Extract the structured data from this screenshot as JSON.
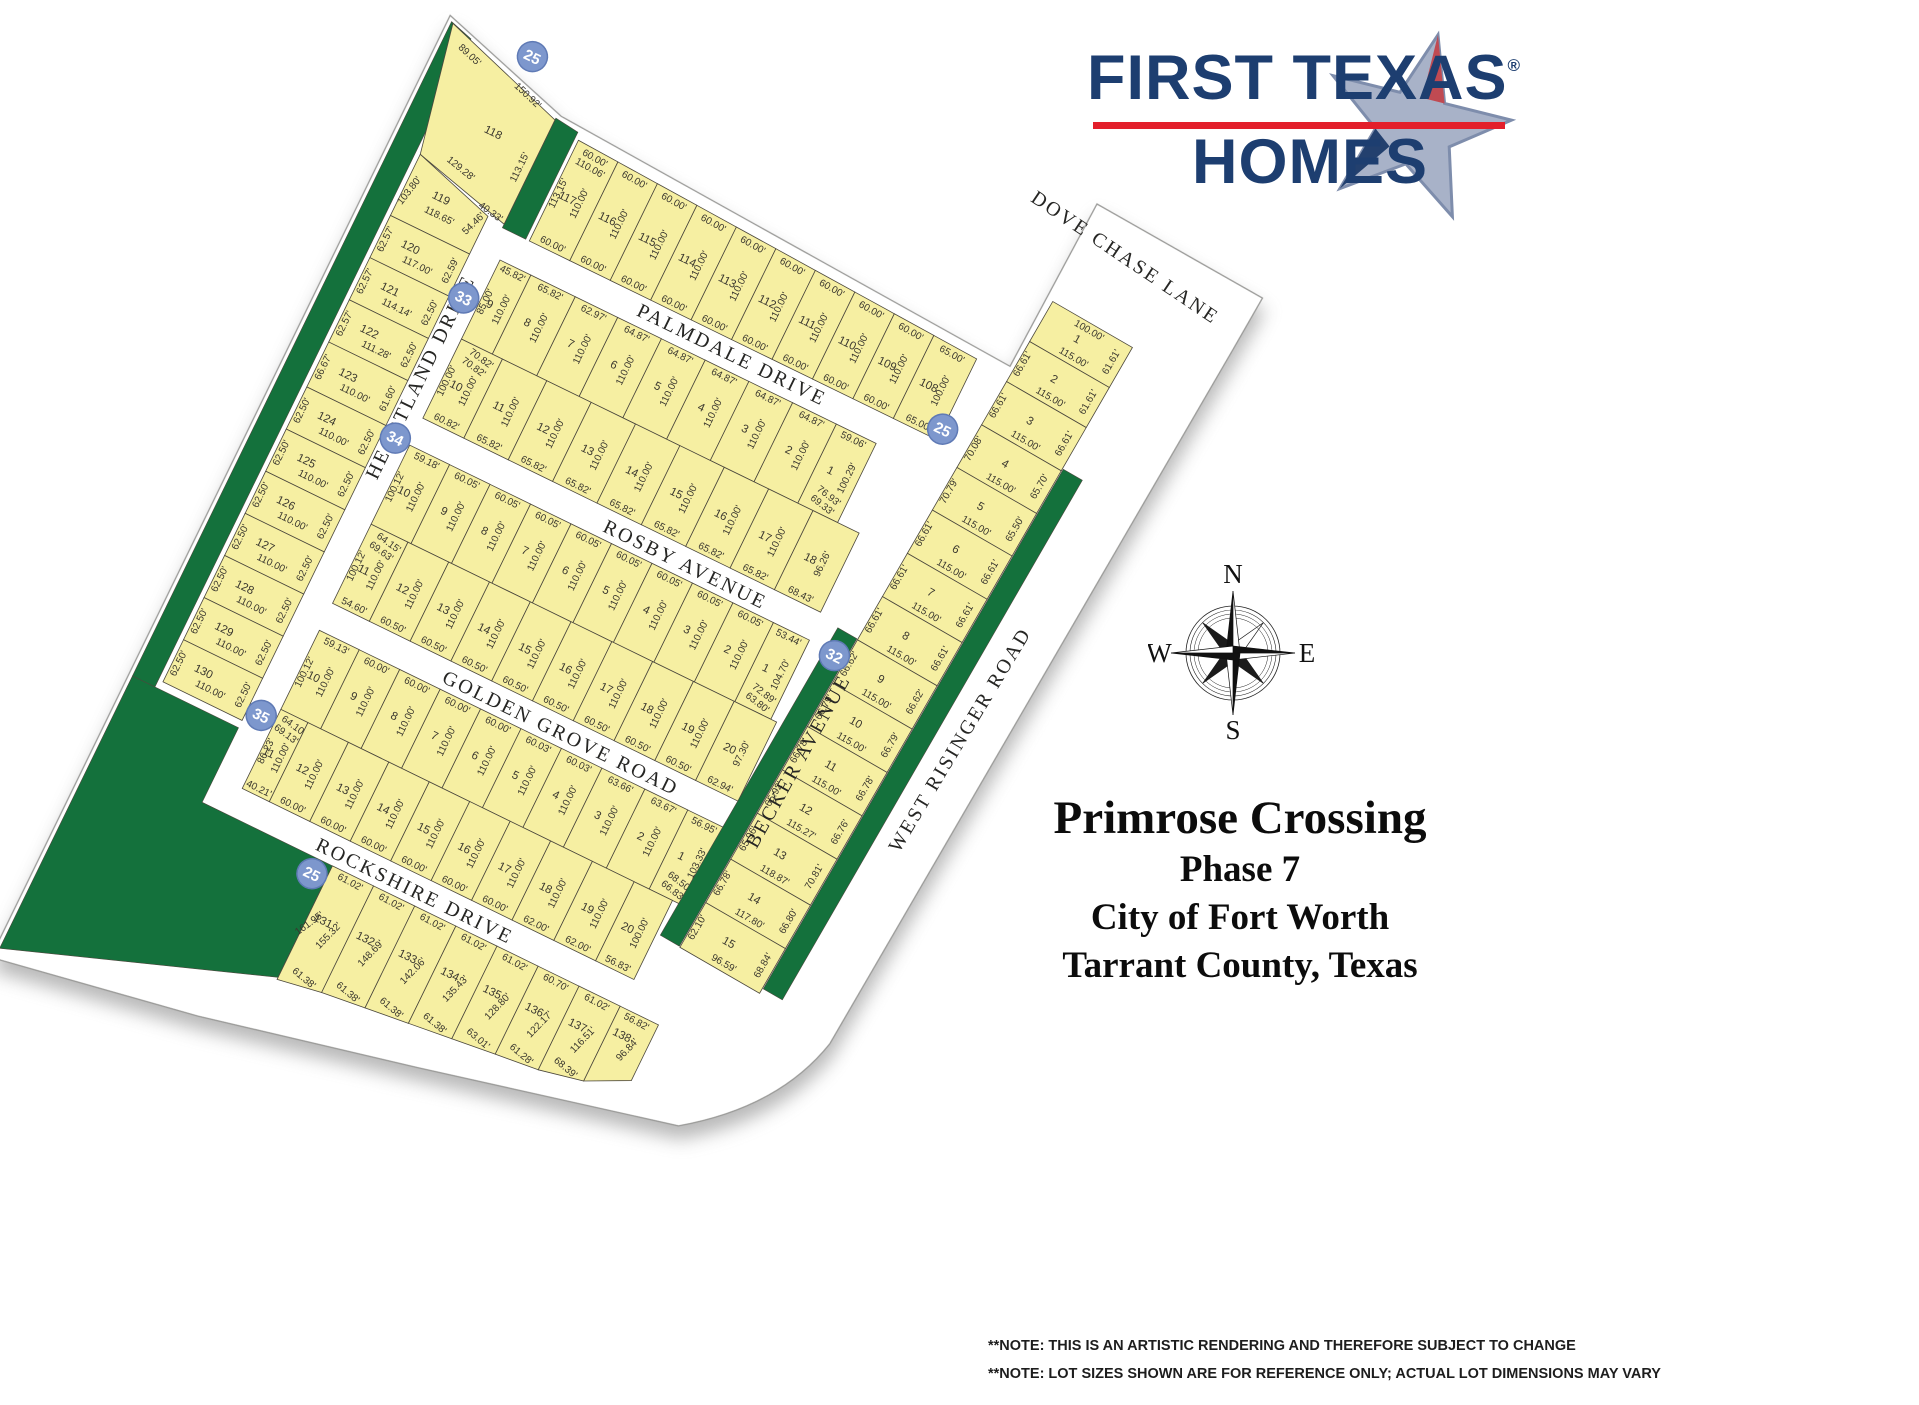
{
  "logo": {
    "line1": "FIRST TEXAS",
    "reg": "®",
    "line2": "HOMES"
  },
  "title": {
    "line1": "Primrose Crossing",
    "line2": "Phase 7",
    "line3": "City of Fort Worth",
    "line4": "Tarrant County, Texas"
  },
  "notes": [
    "**NOTE: THIS IS AN ARTISTIC RENDERING AND THEREFORE SUBJECT TO CHANGE",
    "**NOTE: LOT SIZES SHOWN ARE FOR REFERENCE ONLY; ACTUAL LOT DIMENSIONS MAY VARY"
  ],
  "compass": {
    "n": "N",
    "e": "E",
    "s": "S",
    "w": "W"
  },
  "map": {
    "colors": {
      "lot": "#f6efa2",
      "lot_border": "#4b473c",
      "green": "#14713c",
      "circle": "#7d97cd",
      "circle_border": "#5f7ab5",
      "street_text": "#262624",
      "dim_text": "#3a372e",
      "boundary": "#9a9a98"
    },
    "streets": [
      "PALMDALE DRIVE",
      "ROSBY AVENUE",
      "GOLDEN GROVE ROAD",
      "ROCKSHIRE DRIVE",
      "HEARTLAND DRIVE",
      "BECKER AVENUE",
      "WEST RISINGER ROAD",
      "DOVE CHASE LANE"
    ],
    "circles": [
      "25",
      "25",
      "33",
      "34",
      "35",
      "32",
      "25"
    ],
    "blocks": {
      "north_row": [
        {
          "n": "117",
          "w": "60.00'",
          "d": "110.00'",
          "e": [
            "113.15'",
            "110.06'"
          ]
        },
        {
          "n": "116",
          "w": "60.00'",
          "d": "110.00'"
        },
        {
          "n": "115",
          "w": "60.00'",
          "d": "110.00'"
        },
        {
          "n": "114",
          "w": "60.00'",
          "d": "110.00'"
        },
        {
          "n": "113",
          "w": "60.00'",
          "d": "110.00'"
        },
        {
          "n": "112",
          "w": "60.00'",
          "d": "110.00'"
        },
        {
          "n": "111",
          "w": "60.00'",
          "d": "110.00'"
        },
        {
          "n": "110",
          "w": "60.00'",
          "d": "110.00'"
        },
        {
          "n": "109",
          "w": "60.00'",
          "d": "110.00'"
        },
        {
          "n": "108",
          "w": "65.00'",
          "d": "100.00'"
        }
      ],
      "lot118": {
        "n": "118",
        "e": [
          "89.05'",
          "150.92'",
          "129.28'",
          "113.15'",
          "40.33'"
        ]
      },
      "west_column": [
        {
          "n": "119",
          "w": "103.80'",
          "d": "118.65'",
          "e": [
            "54.46'"
          ]
        },
        {
          "n": "120",
          "w": "62.57'",
          "d": "117.00'",
          "e": [
            "62.59'"
          ]
        },
        {
          "n": "121",
          "w": "62.57'",
          "d": "114.14'",
          "e": [
            "62.50'"
          ]
        },
        {
          "n": "122",
          "w": "62.57'",
          "d": "111.28'",
          "e": [
            "62.50'"
          ]
        },
        {
          "n": "123",
          "w": "66.67'",
          "d": "110.00'",
          "e": [
            "61.60'"
          ]
        },
        {
          "n": "124",
          "w": "62.50'",
          "d": "110.00'",
          "e": [
            "62.50'"
          ]
        },
        {
          "n": "125",
          "w": "62.50'",
          "d": "110.00'",
          "e": [
            "62.50'"
          ]
        },
        {
          "n": "126",
          "w": "62.50'",
          "d": "110.00'",
          "e": [
            "62.50'"
          ]
        },
        {
          "n": "127",
          "w": "62.50'",
          "d": "110.00'",
          "e": [
            "62.50'"
          ]
        },
        {
          "n": "128",
          "w": "62.50'",
          "d": "110.00'",
          "e": [
            "62.50'"
          ]
        },
        {
          "n": "129",
          "w": "62.50'",
          "d": "110.00'",
          "e": [
            "62.50'"
          ]
        },
        {
          "n": "130",
          "w": "62.50'",
          "d": "110.00'",
          "e": [
            "62.50'"
          ]
        }
      ],
      "block33_north": [
        {
          "n": "9",
          "w": "45.82'",
          "d": "110.00'",
          "e": [
            "85.00'"
          ]
        },
        {
          "n": "8",
          "w": "65.82'",
          "d": "110.00'"
        },
        {
          "n": "7",
          "w": "62.97'",
          "d": "110.00'"
        },
        {
          "n": "6",
          "w": "64.87'",
          "d": "110.00'"
        },
        {
          "n": "5",
          "w": "64.87'",
          "d": "110.00'"
        },
        {
          "n": "4",
          "w": "64.87'",
          "d": "110.00'"
        },
        {
          "n": "3",
          "w": "64.87'",
          "d": "110.00'"
        },
        {
          "n": "2",
          "w": "64.87'",
          "d": "110.00'"
        },
        {
          "n": "1",
          "w": "59.06'",
          "d": "100.29'",
          "e": [
            "76.93'",
            "69.33'"
          ]
        }
      ],
      "block33_south": [
        {
          "n": "10",
          "w": "60.82'",
          "d": "110.00'",
          "e": [
            "100.00'",
            "70.82'",
            "70.82'"
          ]
        },
        {
          "n": "11",
          "w": "65.82'",
          "d": "110.00'"
        },
        {
          "n": "12",
          "w": "65.82'",
          "d": "110.00'"
        },
        {
          "n": "13",
          "w": "65.82'",
          "d": "110.00'"
        },
        {
          "n": "14",
          "w": "65.82'",
          "d": "110.00'"
        },
        {
          "n": "15",
          "w": "65.82'",
          "d": "110.00'"
        },
        {
          "n": "16",
          "w": "65.82'",
          "d": "110.00'"
        },
        {
          "n": "17",
          "w": "65.82'",
          "d": "110.00'"
        },
        {
          "n": "18",
          "w": "68.43'",
          "d": "96.26'"
        }
      ],
      "block34_north": [
        {
          "n": "10",
          "w": "59.18'",
          "d": "110.00'",
          "e": [
            "100.12'"
          ]
        },
        {
          "n": "9",
          "w": "60.05'",
          "d": "110.00'"
        },
        {
          "n": "8",
          "w": "60.05'",
          "d": "110.00'"
        },
        {
          "n": "7",
          "w": "60.05'",
          "d": "110.00'"
        },
        {
          "n": "6",
          "w": "60.05'",
          "d": "110.00'"
        },
        {
          "n": "5",
          "w": "60.05'",
          "d": "110.00'"
        },
        {
          "n": "4",
          "w": "60.05'",
          "d": "110.00'"
        },
        {
          "n": "3",
          "w": "60.05'",
          "d": "110.00'"
        },
        {
          "n": "2",
          "w": "60.05'",
          "d": "110.00'"
        },
        {
          "n": "1",
          "w": "53.44'",
          "d": "104.70'",
          "e": [
            "72.89'",
            "63.80'"
          ]
        }
      ],
      "block34_south": [
        {
          "n": "11",
          "w": "54.60'",
          "d": "110.00'",
          "e": [
            "100.12'",
            "64.15'",
            "69.63'"
          ]
        },
        {
          "n": "12",
          "w": "60.50'",
          "d": "110.00'"
        },
        {
          "n": "13",
          "w": "60.50'",
          "d": "110.00'"
        },
        {
          "n": "14",
          "w": "60.50'",
          "d": "110.00'"
        },
        {
          "n": "15",
          "w": "60.50'",
          "d": "110.00'"
        },
        {
          "n": "16",
          "w": "60.50'",
          "d": "110.00'"
        },
        {
          "n": "17",
          "w": "60.50'",
          "d": "110.00'"
        },
        {
          "n": "18",
          "w": "60.50'",
          "d": "110.00'"
        },
        {
          "n": "19",
          "w": "60.50'",
          "d": "110.00'"
        },
        {
          "n": "20",
          "w": "62.94'",
          "d": "97.30'"
        }
      ],
      "block35_north": [
        {
          "n": "10",
          "w": "59.13'",
          "d": "110.00'",
          "e": [
            "100.12'"
          ]
        },
        {
          "n": "9",
          "w": "60.00'",
          "d": "110.00'"
        },
        {
          "n": "8",
          "w": "60.00'",
          "d": "110.00'"
        },
        {
          "n": "7",
          "w": "60.00'",
          "d": "110.00'"
        },
        {
          "n": "6",
          "w": "60.00'",
          "d": "110.00'"
        },
        {
          "n": "5",
          "w": "60.03'",
          "d": "110.00'"
        },
        {
          "n": "4",
          "w": "60.03'",
          "d": "110.00'"
        },
        {
          "n": "3",
          "w": "63.66'",
          "d": "110.00'"
        },
        {
          "n": "2",
          "w": "63.67'",
          "d": "110.00'"
        },
        {
          "n": "1",
          "w": "56.95'",
          "d": "103.33'",
          "e": [
            "68.50'",
            "66.83'"
          ]
        }
      ],
      "block35_south": [
        {
          "n": "11",
          "w": "40.21'",
          "d": "110.00'",
          "e": [
            "86.23'",
            "64.10'",
            "69.13'"
          ]
        },
        {
          "n": "12",
          "w": "60.00'",
          "d": "110.00'"
        },
        {
          "n": "13",
          "w": "60.00'",
          "d": "110.00'"
        },
        {
          "n": "14",
          "w": "60.00'",
          "d": "110.00'"
        },
        {
          "n": "15",
          "w": "60.00'",
          "d": "110.00'"
        },
        {
          "n": "16",
          "w": "60.00'",
          "d": "110.00'"
        },
        {
          "n": "17",
          "w": "60.00'",
          "d": "110.00'"
        },
        {
          "n": "18",
          "w": "62.00'",
          "d": "110.00'"
        },
        {
          "n": "19",
          "w": "62.00'",
          "d": "110.00'"
        },
        {
          "n": "20",
          "w": "56.83'",
          "d": "100.00'"
        }
      ],
      "south_row": [
        {
          "n": "131",
          "w": "61.02'",
          "d": "155.32'",
          "e": [
            "161.95'",
            "61.38'"
          ]
        },
        {
          "n": "132",
          "w": "61.02'",
          "d": "148.69'",
          "e": [
            "61.38'"
          ]
        },
        {
          "n": "133",
          "w": "61.02'",
          "d": "142.06'",
          "e": [
            "61.38'"
          ]
        },
        {
          "n": "134",
          "w": "61.02'",
          "d": "135.43'",
          "e": [
            "61.38'"
          ]
        },
        {
          "n": "135",
          "w": "61.02'",
          "d": "128.80'",
          "e": [
            "63.01'"
          ]
        },
        {
          "n": "136",
          "w": "60.70'",
          "d": "122.17'",
          "e": [
            "61.28'"
          ]
        },
        {
          "n": "137",
          "w": "61.02'",
          "d": "116.51'",
          "e": [
            "68.39'"
          ]
        },
        {
          "n": "138",
          "w": "56.82'",
          "d": "96.84'"
        }
      ],
      "block32": [
        {
          "n": "1",
          "w": "61.61'",
          "d": "115.00'",
          "e": [
            "100.00'"
          ]
        },
        {
          "n": "2",
          "w": "61.61'",
          "d": "115.00'",
          "e": [
            "66.61'"
          ]
        },
        {
          "n": "3",
          "w": "66.61'",
          "d": "115.00'",
          "e": [
            "66.61'"
          ]
        },
        {
          "n": "4",
          "w": "65.70'",
          "d": "115.00'",
          "e": [
            "70.08'"
          ]
        },
        {
          "n": "5",
          "w": "65.50'",
          "d": "115.00'",
          "e": [
            "70.79'"
          ]
        },
        {
          "n": "6",
          "w": "66.61'",
          "d": "115.00'",
          "e": [
            "66.61'"
          ]
        },
        {
          "n": "7",
          "w": "66.61'",
          "d": "115.00'",
          "e": [
            "66.61'"
          ]
        },
        {
          "n": "8",
          "w": "66.61'",
          "d": "115.00'",
          "e": [
            "66.61'"
          ]
        },
        {
          "n": "9",
          "w": "66.62'",
          "d": "115.00'",
          "e": [
            "66.62'"
          ]
        },
        {
          "n": "10",
          "w": "66.79'",
          "d": "115.00'",
          "e": [
            "66.79'"
          ]
        },
        {
          "n": "11",
          "w": "66.78'",
          "d": "115.00'",
          "e": [
            "66.78'"
          ]
        },
        {
          "n": "12",
          "w": "66.76'",
          "d": "115.27'",
          "e": [
            "65.92'"
          ]
        },
        {
          "n": "13",
          "w": "70.81'",
          "d": "118.87'",
          "e": [
            "65.96'"
          ]
        },
        {
          "n": "14",
          "w": "66.80'",
          "d": "117.80'",
          "e": [
            "66.78'"
          ]
        },
        {
          "n": "15",
          "w": "68.84'",
          "d": "96.59'",
          "e": [
            "62.10'"
          ]
        }
      ]
    }
  }
}
